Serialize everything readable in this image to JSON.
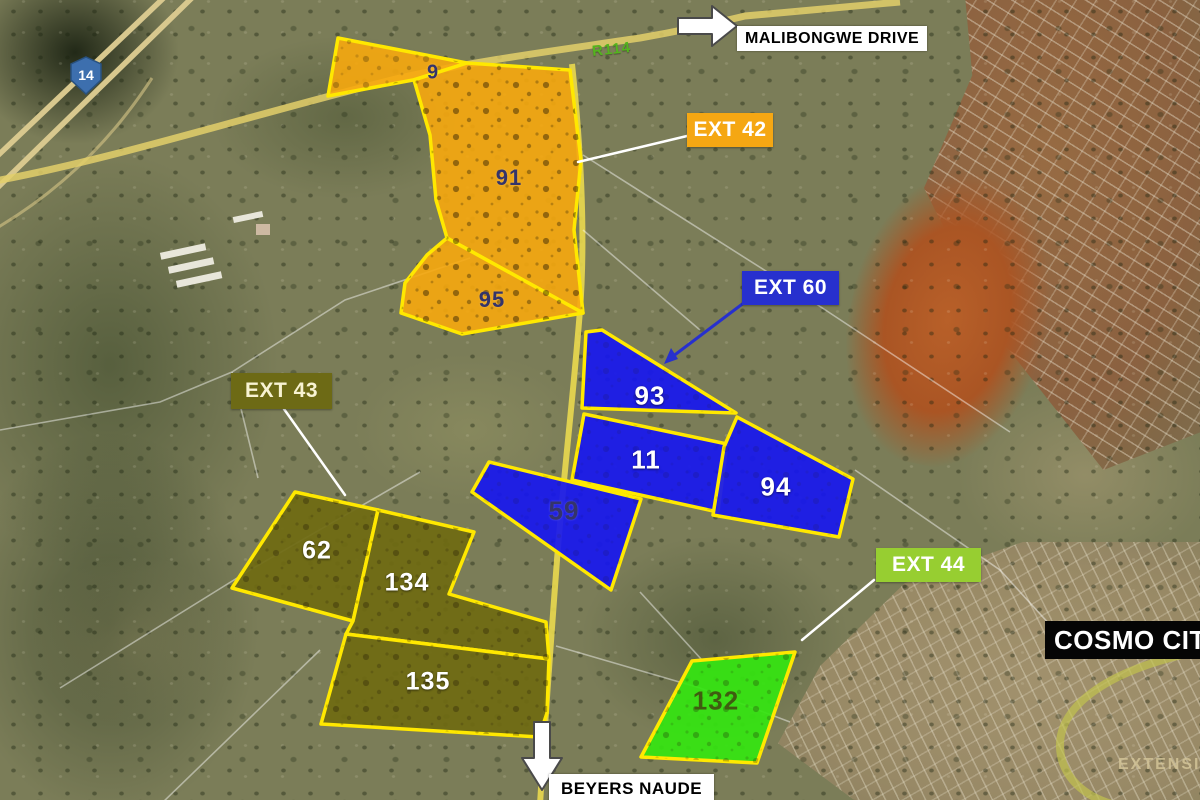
{
  "map_type": "aerial-satellite-extension-plan",
  "road_labels": {
    "malibongwe_drive": "MALIBONGWE DRIVE",
    "beyers_naude": "BEYERS NAUDE",
    "r114": "R114",
    "n14_shield": "14",
    "cosmo_city": "COSMO CITY",
    "extension_faint": "EXTENSI"
  },
  "extension_labels": [
    {
      "label": "EXT 42",
      "color": "#F5A713"
    },
    {
      "label": "EXT 60",
      "color": "#2730CE"
    },
    {
      "label": "EXT 43",
      "color": "#6D6A15"
    },
    {
      "label": "EXT 44",
      "color": "#97CE31"
    }
  ],
  "parcels": [
    {
      "number": "9",
      "extension": "EXT 42"
    },
    {
      "number": "91",
      "extension": "EXT 42"
    },
    {
      "number": "95",
      "extension": "EXT 42"
    },
    {
      "number": "93",
      "extension": "EXT 60"
    },
    {
      "number": "11",
      "extension": "EXT 60"
    },
    {
      "number": "94",
      "extension": "EXT 60"
    },
    {
      "number": "59",
      "extension": "EXT 60"
    },
    {
      "number": "62",
      "extension": "EXT 43"
    },
    {
      "number": "134",
      "extension": "EXT 43"
    },
    {
      "number": "135",
      "extension": "EXT 43"
    },
    {
      "number": "132",
      "extension": "EXT 44"
    }
  ],
  "colors": {
    "ext42_parcel_fill": "#F7A80E",
    "ext60_parcel_fill": "#1717EF",
    "ext43_parcel_fill": "#6F6A12",
    "ext44_parcel_fill": "#35E511",
    "parcel_border": "#FFE800",
    "road_yellow": "#EAD94F",
    "highway_tan": "#D8C88E"
  }
}
